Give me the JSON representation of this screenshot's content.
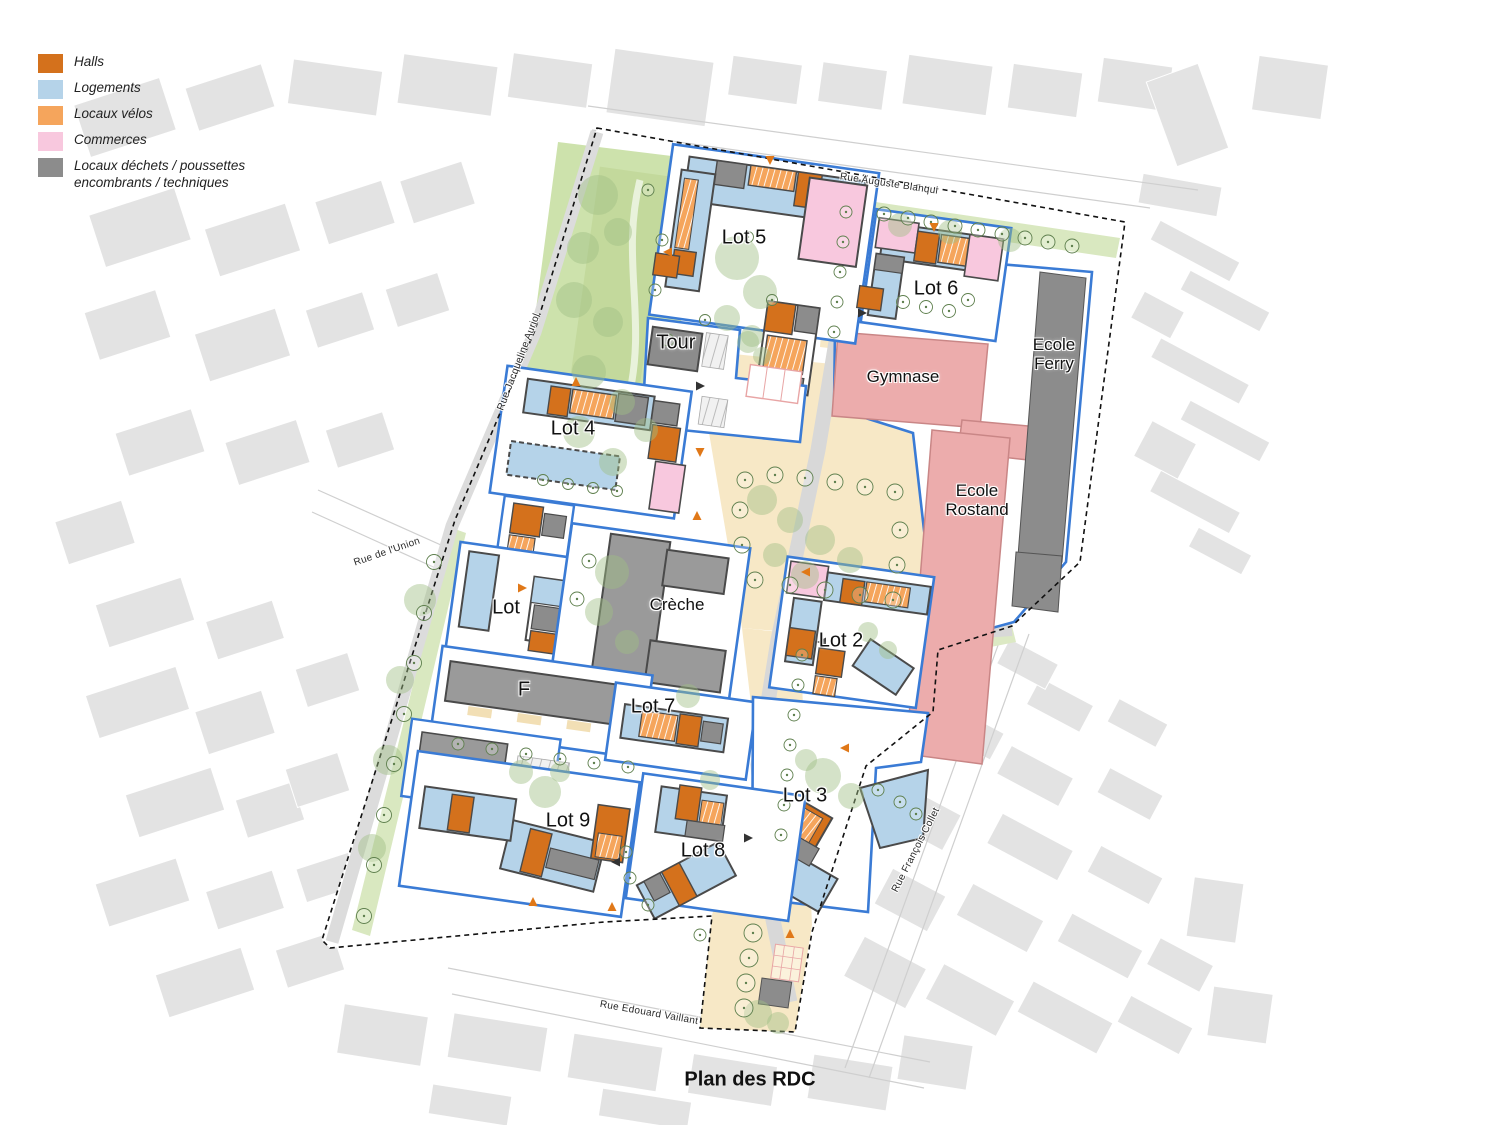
{
  "title": "Plan des RDC",
  "legend": {
    "items": [
      {
        "label": "Halls",
        "color": "#D4711C"
      },
      {
        "label": "Logements",
        "color": "#B5D3E9"
      },
      {
        "label": "Locaux vélos",
        "color": "#F5A55C"
      },
      {
        "label": "Commerces",
        "color": "#F8C8DE"
      },
      {
        "label": "Locaux déchets / poussettes encombrants / techniques",
        "color": "#8C8C8C"
      }
    ]
  },
  "map": {
    "streets": [
      {
        "name": "Rue Auguste Blanqui"
      },
      {
        "name": "Rue Jacqueline Auriol"
      },
      {
        "name": "Rue de l'Union"
      },
      {
        "name": "Rue Edouard Vaillant"
      },
      {
        "name": "Rue François Collet"
      }
    ],
    "labels": [
      {
        "text": "Lot 5"
      },
      {
        "text": "Lot 6"
      },
      {
        "text": "Tour"
      },
      {
        "text": "Lot 4"
      },
      {
        "text": "Gymnase"
      },
      {
        "text": "Ecole Ferry"
      },
      {
        "text": "Ecole Rostand"
      },
      {
        "text": "Lot"
      },
      {
        "text": "Crèche"
      },
      {
        "text": "Lot 2"
      },
      {
        "text": "F"
      },
      {
        "text": "Lot 7"
      },
      {
        "text": "Lot 3"
      },
      {
        "text": "Lot 9"
      },
      {
        "text": "Lot 8"
      }
    ]
  },
  "colors": {
    "lot_border": "#3A7BD5",
    "building_outline": "#4A4A4A",
    "school_fill": "#ECACAC",
    "school_border": "#C98686",
    "park_green": "#CDE2AC",
    "verge_green": "#D9E8C0",
    "public_space_beige": "#F7E8C6",
    "road_gray": "#D8D8D8",
    "city_block_gray": "#E3E3E3",
    "boundary_black": "#111111"
  }
}
